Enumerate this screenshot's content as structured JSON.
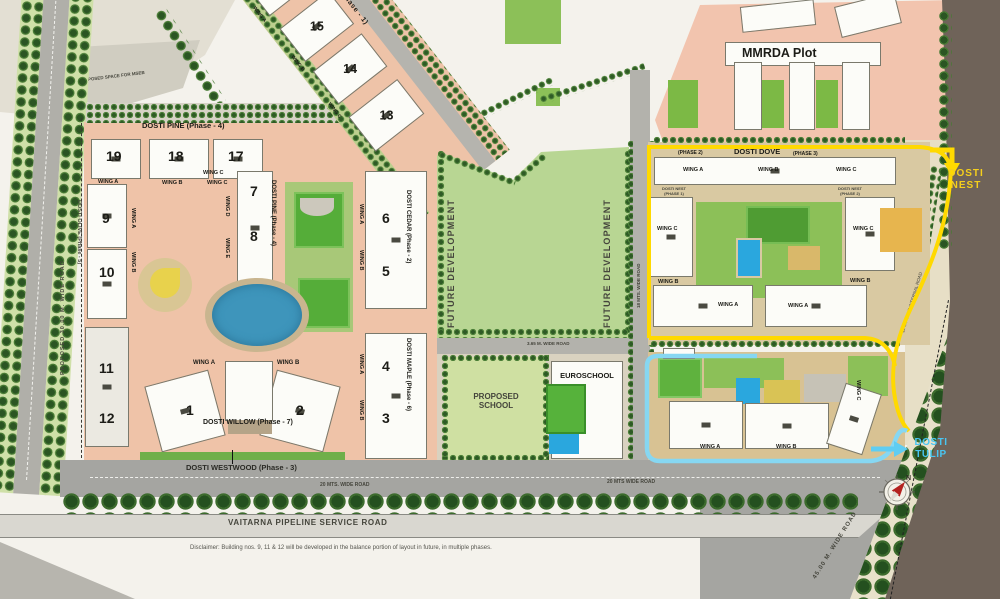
{
  "colors": {
    "estate_pink": "#efc3a8",
    "tan_block": "#d9c9a2",
    "future_green": "#b8d693",
    "lawn_green": "#8cc058",
    "court_green": "#5fb23e",
    "road_grey": "#a5a5a1",
    "dark_road_brown": "#6f6359",
    "water_blue": "#3e95bb",
    "pool_blue": "#2aa7de",
    "boundary_yellow": "#ffd900",
    "boundary_cyan": "#86d7f2",
    "nest_text_yellow": "#f5cf1c",
    "tulip_text_cyan": "#49c6f2"
  },
  "labels": {
    "mseb": "PROPOSED SPACE FOR MSEB",
    "left_road": "PROPOSED 30.00 M. WIDE ROAD",
    "oak": {
      "title": "DOSTI OAK (Phase - 1)",
      "b16": "16",
      "b15": "15",
      "b14": "14",
      "b13": "13",
      "wing_a": "WING A",
      "wing_b": "WING B",
      "wing_c": "WING C"
    },
    "pine": {
      "title": "DOSTI PINE (Phase - 4)",
      "b19": "19",
      "b18": "18",
      "b17": "17",
      "wing_a": "WING A",
      "wing_b": "WING B",
      "wing_c": "WING C"
    },
    "pine_tower": {
      "title": "DOSTI PINE (Phase - 4)",
      "b7": "7",
      "b8": "8",
      "wing_c": "WING C",
      "wing_d": "WING D",
      "wing_e": "WING E"
    },
    "olive": {
      "title": "DOSTI OLIVE (Phase - 5)",
      "b9": "9",
      "b10": "10",
      "b11": "11",
      "b12": "12",
      "wing_a": "WING A",
      "wing_b": "WING B"
    },
    "cedar": {
      "title": "DOSTI CEDAR (Phase - 2)",
      "b6": "6",
      "b5": "5",
      "wing_a": "WING A",
      "wing_b": "WING B"
    },
    "maple": {
      "title": "DOSTI MAPLE (Phase - 6)",
      "b4": "4",
      "b3": "3",
      "wing_a": "WING A",
      "wing_b": "WING B"
    },
    "willow": {
      "title": "DOSTI WILLOW (Phase - 7)",
      "b1": "1",
      "b2": "2",
      "wing_a": "WING A",
      "wing_b": "WING B"
    },
    "westwood": {
      "title": "DOSTI WESTWOOD (Phase - 3)"
    },
    "future_development": "FUTURE DEVELOPMENT",
    "roads": {
      "wide_20_left": "20 MTS. WIDE ROAD",
      "wide_20_right": "20 MTS WIDE ROAD",
      "wide_18": "18 MTS. WIDE ROAD",
      "wide_365": "3.65 M. WIDE ROAD",
      "internal_12": "12 MT WIDE INTERNAL ROAD",
      "wide_45": "45.00 M. WIDE ROAD",
      "vaitarna": "VAITARNA PIPELINE SERVICE ROAD"
    },
    "schools": {
      "proposed_line1": "PROPOSED",
      "proposed_line2": "SCHOOL",
      "euroschool": "EUROSCHOOL"
    },
    "mmrda": "MMRDA Plot",
    "dove": {
      "title": "DOSTI DOVE",
      "phase2": "(PHASE 2)",
      "phase3": "(PHASE 3)",
      "wing_a": "WING A",
      "wing_b": "WING B",
      "wing_c": "WING C",
      "nest_p1_l1": "DOSTI NEST",
      "nest_p1_l2": "(PHASE 1)",
      "nest_p2_l1": "DOSTI NEST",
      "nest_p2_l2": "(PHASE 2)"
    },
    "nest": {
      "l1": "DOSTI",
      "l2": "NEST"
    },
    "tulip": {
      "l1": "DOSTI",
      "l2": "TULIP",
      "wing_a": "WING A",
      "wing_b": "WING B",
      "wing_c": "WING C"
    },
    "compass_n": "N",
    "disclaimer": "Disclaimer: Building nos. 9, 11 & 12 will be developed in the balance portion of layout in future, in multiple phases."
  }
}
